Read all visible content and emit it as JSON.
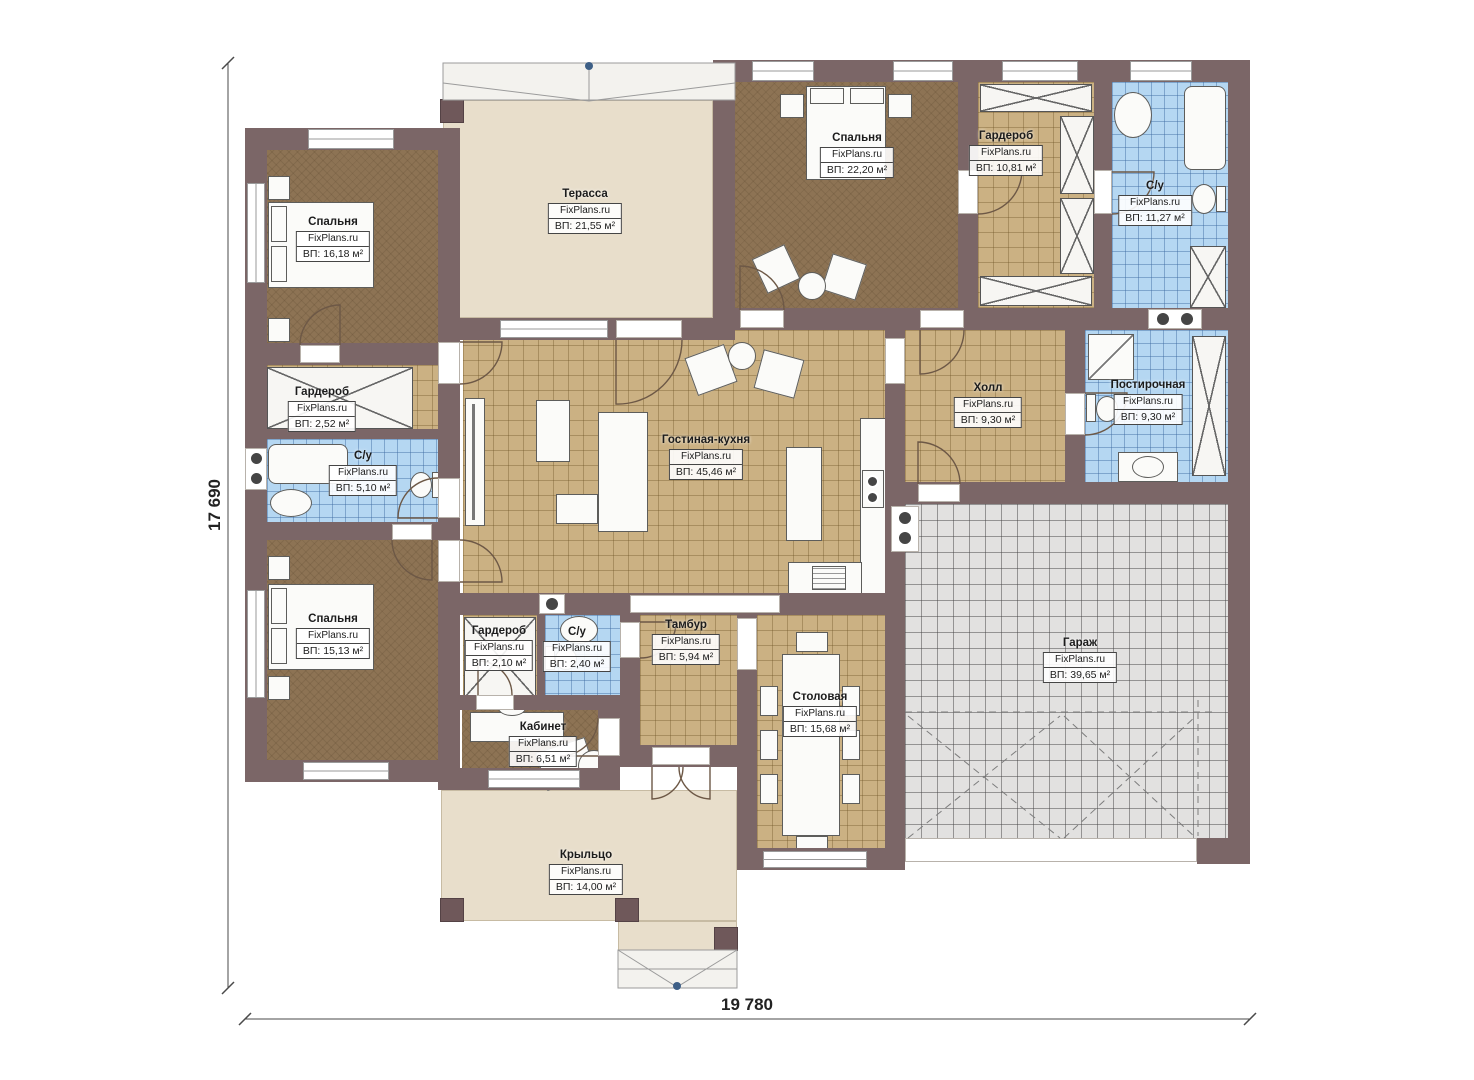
{
  "plan": {
    "watermark": "FixPlans.ru",
    "dimension_height": "17 690",
    "dimension_width": "19 780",
    "rooms": [
      {
        "id": "bedroom-1",
        "name": "Спальня",
        "watermark": "FixPlans.ru",
        "area": "ВП: 16,18 м²"
      },
      {
        "id": "terrace",
        "name": "Терасса",
        "watermark": "FixPlans.ru",
        "area": "ВП: 21,55 м²"
      },
      {
        "id": "bedroom-2",
        "name": "Спальня",
        "watermark": "FixPlans.ru",
        "area": "ВП: 22,20 м²"
      },
      {
        "id": "wardrobe-1",
        "name": "Гардероб",
        "watermark": "FixPlans.ru",
        "area": "ВП: 10,81 м²"
      },
      {
        "id": "bathroom-1",
        "name": "С/у",
        "watermark": "FixPlans.ru",
        "area": "ВП: 11,27 м²"
      },
      {
        "id": "wardrobe-2",
        "name": "Гардероб",
        "watermark": "FixPlans.ru",
        "area": "ВП: 2,52 м²"
      },
      {
        "id": "bathroom-2",
        "name": "С/у",
        "watermark": "FixPlans.ru",
        "area": "ВП: 5,10 м²"
      },
      {
        "id": "living-kitchen",
        "name": "Гостиная-кухня",
        "watermark": "FixPlans.ru",
        "area": "ВП: 45,46 м²"
      },
      {
        "id": "hall",
        "name": "Холл",
        "watermark": "FixPlans.ru",
        "area": "ВП: 9,30 м²"
      },
      {
        "id": "laundry",
        "name": "Постирочная",
        "watermark": "FixPlans.ru",
        "area": "ВП: 9,30 м²"
      },
      {
        "id": "bedroom-3",
        "name": "Спальня",
        "watermark": "FixPlans.ru",
        "area": "ВП: 15,13 м²"
      },
      {
        "id": "wardrobe-3",
        "name": "Гардероб",
        "watermark": "FixPlans.ru",
        "area": "ВП: 2,10 м²"
      },
      {
        "id": "bathroom-3",
        "name": "С/у",
        "watermark": "FixPlans.ru",
        "area": "ВП: 2,40 м²"
      },
      {
        "id": "vestibule",
        "name": "Тамбур",
        "watermark": "FixPlans.ru",
        "area": "ВП: 5,94 м²"
      },
      {
        "id": "study",
        "name": "Кабинет",
        "watermark": "FixPlans.ru",
        "area": "ВП: 6,51 м²"
      },
      {
        "id": "dining",
        "name": "Столовая",
        "watermark": "FixPlans.ru",
        "area": "ВП: 15,68 м²"
      },
      {
        "id": "garage",
        "name": "Гараж",
        "watermark": "FixPlans.ru",
        "area": "ВП: 39,65 м²"
      },
      {
        "id": "porch",
        "name": "Крыльцо",
        "watermark": "FixPlans.ru",
        "area": "ВП: 14,00 м²"
      }
    ],
    "colors": {
      "wall": "#7b6667",
      "floor_wood": "#8d7354",
      "floor_tile": "#cbb183",
      "floor_wet": "#b5d7f2",
      "floor_outdoor": "#e8decb",
      "floor_garage": "#e2e1e0",
      "marker_blue": "#3d5f86"
    }
  }
}
